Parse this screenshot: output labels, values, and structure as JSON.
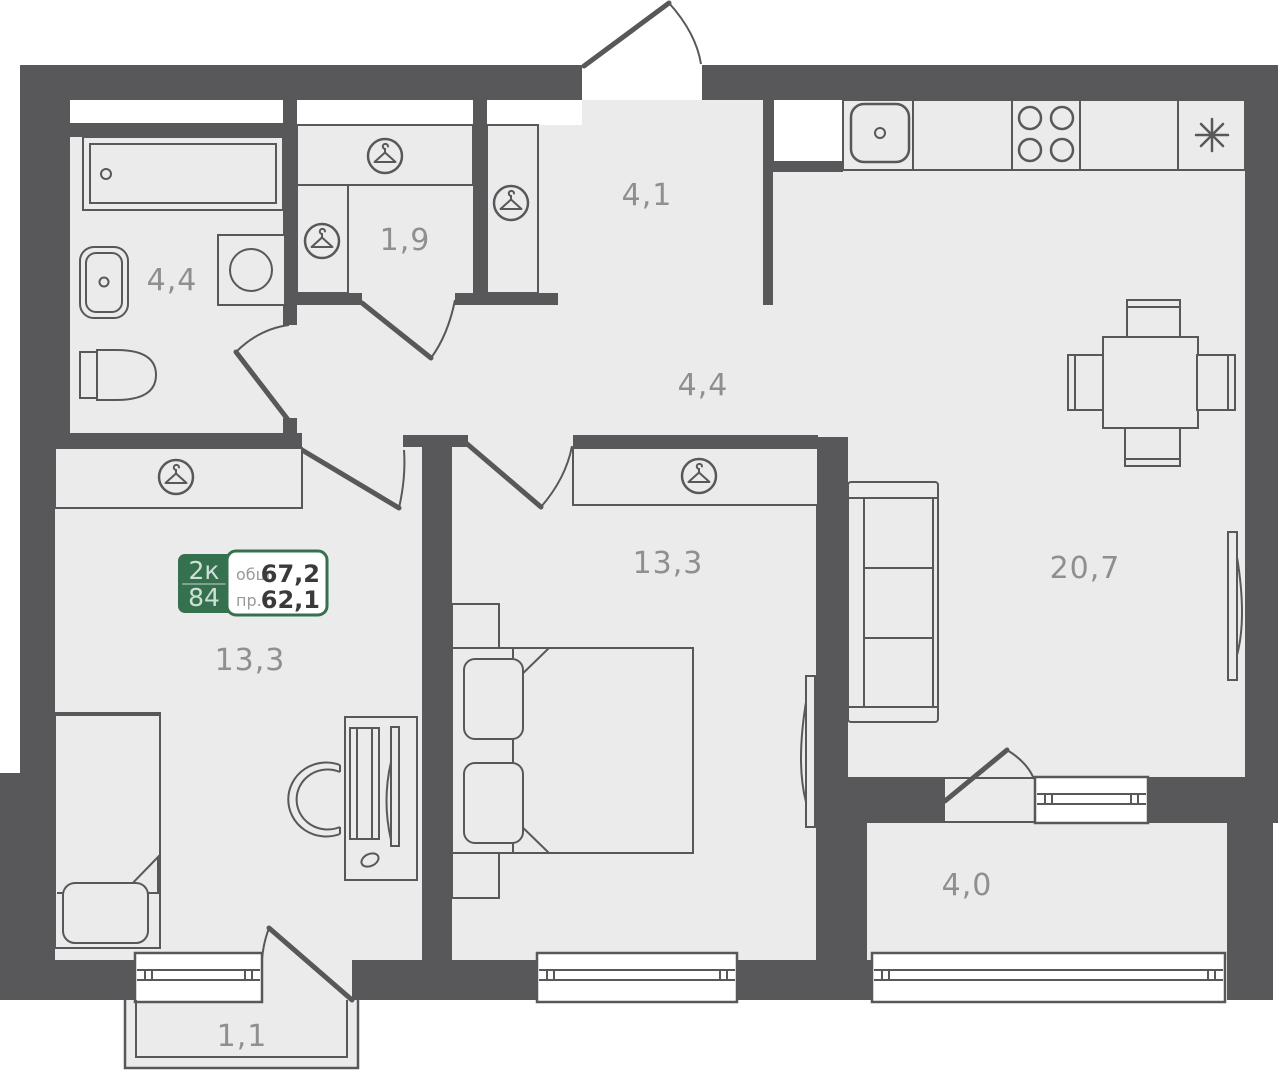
{
  "floor_plan": {
    "info_badge": {
      "type_label": "2к",
      "plan_number": "84",
      "total_area_label": "общ.",
      "total_area_value": "67,2",
      "living_area_label": "пр.",
      "living_area_value": "62,1"
    },
    "rooms": [
      {
        "name": "bathroom",
        "area": "4,4"
      },
      {
        "name": "wardrobe-hall",
        "area": "1,9"
      },
      {
        "name": "entry-hall",
        "area": "4,1"
      },
      {
        "name": "corridor",
        "area": "4,4"
      },
      {
        "name": "room-left",
        "area": "13,3"
      },
      {
        "name": "bedroom",
        "area": "13,3"
      },
      {
        "name": "kitchen-living-room",
        "area": "20,7"
      },
      {
        "name": "loggia",
        "area": "4,0"
      },
      {
        "name": "balcony",
        "area": "1,1"
      }
    ],
    "icons": {
      "wardrobe": "hanger-in-circle",
      "fridge": "asterisk-snowflake",
      "stove": "four-burner-circles",
      "kitchen_sink": "rounded-square-with-drain",
      "bath": "bathtub-with-drain",
      "toilet": "toilet-side",
      "washer": "square-with-drum"
    },
    "colors": {
      "wall": "#58585a",
      "floor": "#ebebeb",
      "outline": "#58585a",
      "label_text": "#8f8f8f",
      "badge_green": "#35714f",
      "badge_number_text": "#3a3a3a",
      "badge_light_text": "#cfe0d6",
      "background": "#ffffff"
    }
  }
}
